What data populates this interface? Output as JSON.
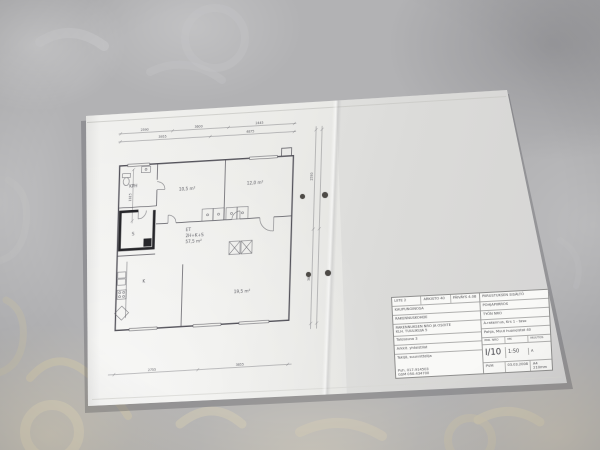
{
  "colors": {
    "fabric_base": "#b2b2b4",
    "fabric_pattern_beige": "#d5ccb4",
    "paper": "#eeeeec",
    "drawing_ink": "#53525a",
    "sauna_wall": "#26262a"
  },
  "plan": {
    "rooms": {
      "kph": "KPH",
      "sauna": "S",
      "bedroom1": "10,5 m²",
      "bedroom2": "12,0 m²",
      "hall": "ET",
      "kitchen": "K",
      "living": "19,5 m²"
    },
    "summary": {
      "line1": "2H+K+S",
      "line2": "57,5 m²"
    },
    "dims": {
      "top1": [
        "2590",
        "3600",
        "2445"
      ],
      "top2": [
        "3955",
        "4875"
      ],
      "bottom": [
        "2755",
        "3655"
      ],
      "right": [
        "2590",
        "3600"
      ],
      "left": "1815"
    }
  },
  "titleblock": {
    "row1": [
      "LIITE 2",
      "ARKISTO 40",
      "PÄIVÄYS 4.08"
    ],
    "left": [
      "KAUPUNGINOSA",
      "RAKENNUSKOHDE",
      "RAKENNUKSEN NRO JA OSOITE",
      "KLH. TUULIKUJA 5",
      "Talosauna 3",
      "Arkkit. yhteistilat"
    ],
    "contact_label": "Tekijä, suunnittelija",
    "contact1": "Puh. 017-914503",
    "contact2": "GSM 050-434700",
    "right": [
      "PIIRUSTUKSEN SISÄLTÖ",
      "POHJAPIIRROS",
      "TYÖN NRO",
      "A-rakennus, Krs 1 - taso",
      "Pohja, Muut huoneistot 40"
    ],
    "drawno_label": "PIIR. NRO",
    "scale_label": "MK",
    "rev_label": "MUUTOS",
    "drawno": "I/10",
    "scale": "1:50",
    "rev": "A",
    "date_label": "PVM",
    "date": "03.03.2008",
    "sheet": "A4 210mm"
  }
}
